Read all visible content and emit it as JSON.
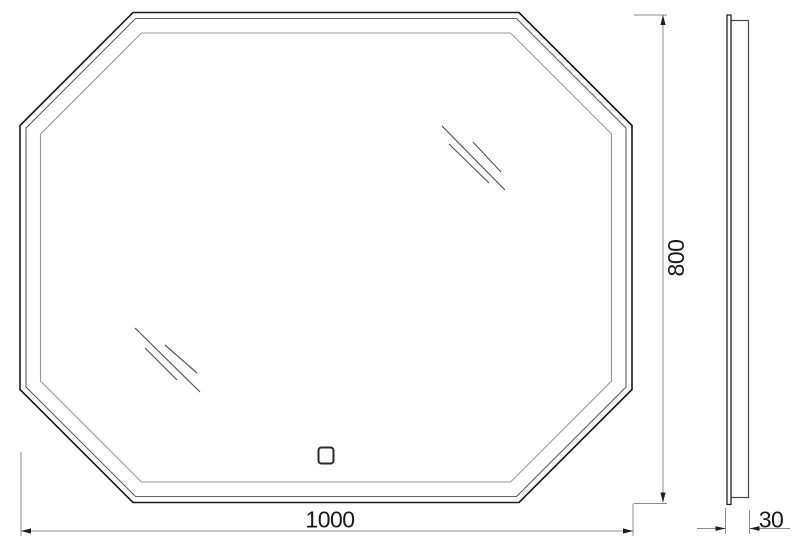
{
  "drawing_type": "technical-drawing-octagonal-mirror",
  "style": {
    "background": "#ffffff",
    "outer_outline_color": "#1a1a1a",
    "bevel_outline_color": "#5f5f5f",
    "inner_outline_color": "#9b9b9b",
    "dim_line_color": "#8c8c8c",
    "arrow_color": "#1f1f1f",
    "text_color": "#1a1a1a",
    "shine_color": "#5a5a5a",
    "button_color": "#2b2b2b",
    "side_body_color": "#4d4d4d"
  },
  "front_view": {
    "outlines": {
      "outer": {
        "points": "133,12.5 519,12.5 632,125.5 632,389.5 519,502.5 133,502.5 20,389.5 20,125.5"
      },
      "bevel": {
        "points": "135.5,18.5 516.5,18.5 626,128 626,387 516.5,496.5 135.5,496.5 26,387 26,128"
      },
      "inner": {
        "points": "141.5,33 510.5,33 611.5,134 611.5,381 510.5,482 141.5,482 40.5,381 40.5,134"
      }
    },
    "shine_marks": {
      "top_right": {
        "l1": "442,126 505,190",
        "l2": "449,144 489,183",
        "l3": "473,142 501,172"
      },
      "bottom_left": {
        "l1": "135,328 200,392",
        "l2": "145,348 177,380",
        "l3": "165,345 197,373"
      }
    },
    "touch_button": {
      "x": "318.5",
      "y": "447.5",
      "width": "15",
      "height": "16",
      "rx": "3"
    }
  },
  "side_view": {
    "glass": {
      "x": "727",
      "y": "15",
      "width": "4",
      "height": "489.5"
    },
    "body": {
      "points": "731,20.5 748.5,20.5 748.5,497.5 731,497.5"
    }
  },
  "dimensions": {
    "width": {
      "value": "1000",
      "ext_left": "21,452 21,536",
      "ext_right": "633,503.5 633,536",
      "line": "21,531 633,531",
      "arrow_left": "21,531 31,528.4 31,533.6",
      "arrow_right": "633,531 623,528.4 623,533.6",
      "label_x": "330",
      "label_y": "527.5"
    },
    "height": {
      "value": "800",
      "ext_top": "634,15 667,15",
      "ext_bottom": "634,503.5 667,503.5",
      "line": "663,15 663,502.5",
      "arrow_top": "663,15 660.4,25 665.6,25",
      "arrow_bottom": "663,502.5 660.4,492.5 665.6,492.5",
      "label_transform": "translate(684,258) rotate(-90)"
    },
    "depth": {
      "value": "30",
      "ext_left": "725.5,508 725.5,534",
      "ext_right": "749.5,510 749.5,534",
      "tail_left": "697,528.5 725.5,528.5",
      "tail_right": "749.5,528.5 790,528.5",
      "arrow_left": "725.5,528.5 715.5,526.1 715.5,530.9",
      "arrow_right": "749.5,528.5 759.5,526.1 759.5,530.9",
      "label_x": "771",
      "label_y": "527.5"
    }
  }
}
